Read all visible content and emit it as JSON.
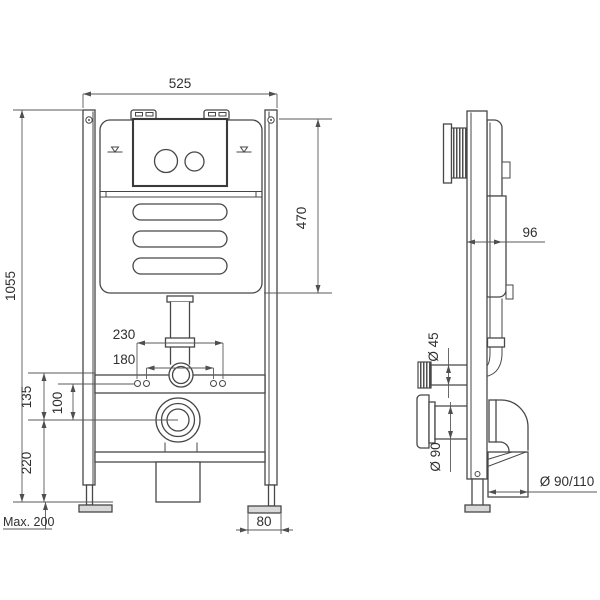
{
  "colors": {
    "background": "#ffffff",
    "line": "#474747",
    "dimension_line": "#5a5a5a",
    "text": "#2f2f2f",
    "foot_fill": "#d9d9d9"
  },
  "front_view": {
    "dimensions": {
      "overall_width": "525",
      "overall_height": "1055",
      "cistern_height": "470",
      "fixing_holes_outer": "230",
      "fixing_holes_inner": "180",
      "offset_upper": "135",
      "offset_inner": "100",
      "outlet_height": "220",
      "foot_adjustment": "Max. 200",
      "foot_width": "80"
    }
  },
  "side_view": {
    "dimensions": {
      "frame_depth": "96",
      "flush_pipe_diameter": "Ø 45",
      "drain_flange_diameter": "Ø 90",
      "waste_outlet_diameter": "Ø 90/110"
    }
  }
}
